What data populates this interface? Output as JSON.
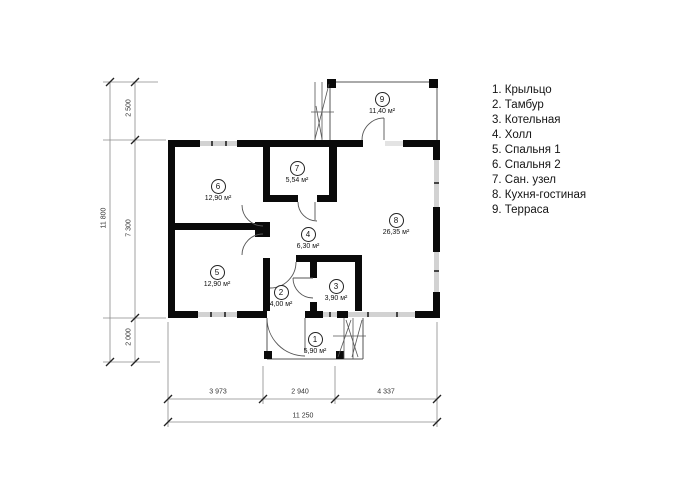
{
  "colors": {
    "wall": "#0a0a0a",
    "thin_line": "#555555",
    "window_fill": "#d2d2d2",
    "text": "#1a1a1a",
    "background": "#ffffff"
  },
  "rooms": [
    {
      "number": "1",
      "area": "5,90 м²"
    },
    {
      "number": "2",
      "area": "4,00 м²"
    },
    {
      "number": "3",
      "area": "3,90 м²"
    },
    {
      "number": "4",
      "area": "6,30 м²"
    },
    {
      "number": "5",
      "area": "12,90 м²"
    },
    {
      "number": "6",
      "area": "12,90 м²"
    },
    {
      "number": "7",
      "area": "5,54 м²"
    },
    {
      "number": "8",
      "area": "26,35 м²"
    },
    {
      "number": "9",
      "area": "11,40 м²"
    }
  ],
  "legend": {
    "items": [
      {
        "text": "1. Крыльцо"
      },
      {
        "text": "2. Тамбур"
      },
      {
        "text": "3. Котельная"
      },
      {
        "text": "4. Холл"
      },
      {
        "text": "5. Спальня 1"
      },
      {
        "text": "6. Спальня 2"
      },
      {
        "text": "7. Сан. узел"
      },
      {
        "text": "8. Кухня-гостиная"
      },
      {
        "text": "9. Терраса"
      }
    ]
  },
  "dimensions": {
    "left": {
      "total": "11 800",
      "segments": [
        "2 500",
        "7 300",
        "2 000"
      ]
    },
    "bottom": {
      "total": "11 250",
      "segments": [
        "3 973",
        "2 940",
        "4 337"
      ]
    }
  }
}
